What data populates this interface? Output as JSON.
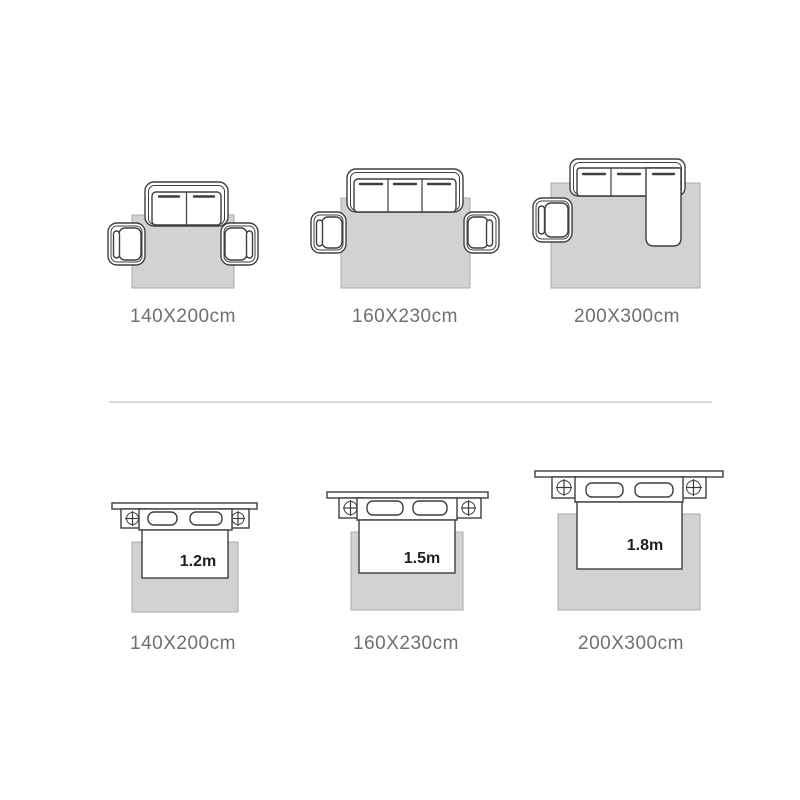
{
  "canvas": {
    "width": 800,
    "height": 800,
    "background": "#ffffff"
  },
  "colors": {
    "canvas_bg": "#ffffff",
    "rug_fill": "#d2d2d2",
    "rug_border": "#ababab",
    "furniture_line": "#3f3f3f",
    "label_text": "#6f6f6f",
    "size_text": "#1f1f1f",
    "divider": "#cbcbcb"
  },
  "sofa_row": {
    "panels": [
      {
        "label": "140X200cm",
        "furniture": "two-seat sofa with two armchairs"
      },
      {
        "label": "160X230cm",
        "furniture": "three-seat sofa with two armchairs"
      },
      {
        "label": "200X300cm",
        "furniture": "sectional chaise sofa with one armchair"
      }
    ]
  },
  "bed_row": {
    "panels": [
      {
        "label": "140X200cm",
        "bed_width": "1.2m"
      },
      {
        "label": "160X230cm",
        "bed_width": "1.5m"
      },
      {
        "label": "200X300cm",
        "bed_width": "1.8m"
      }
    ]
  }
}
